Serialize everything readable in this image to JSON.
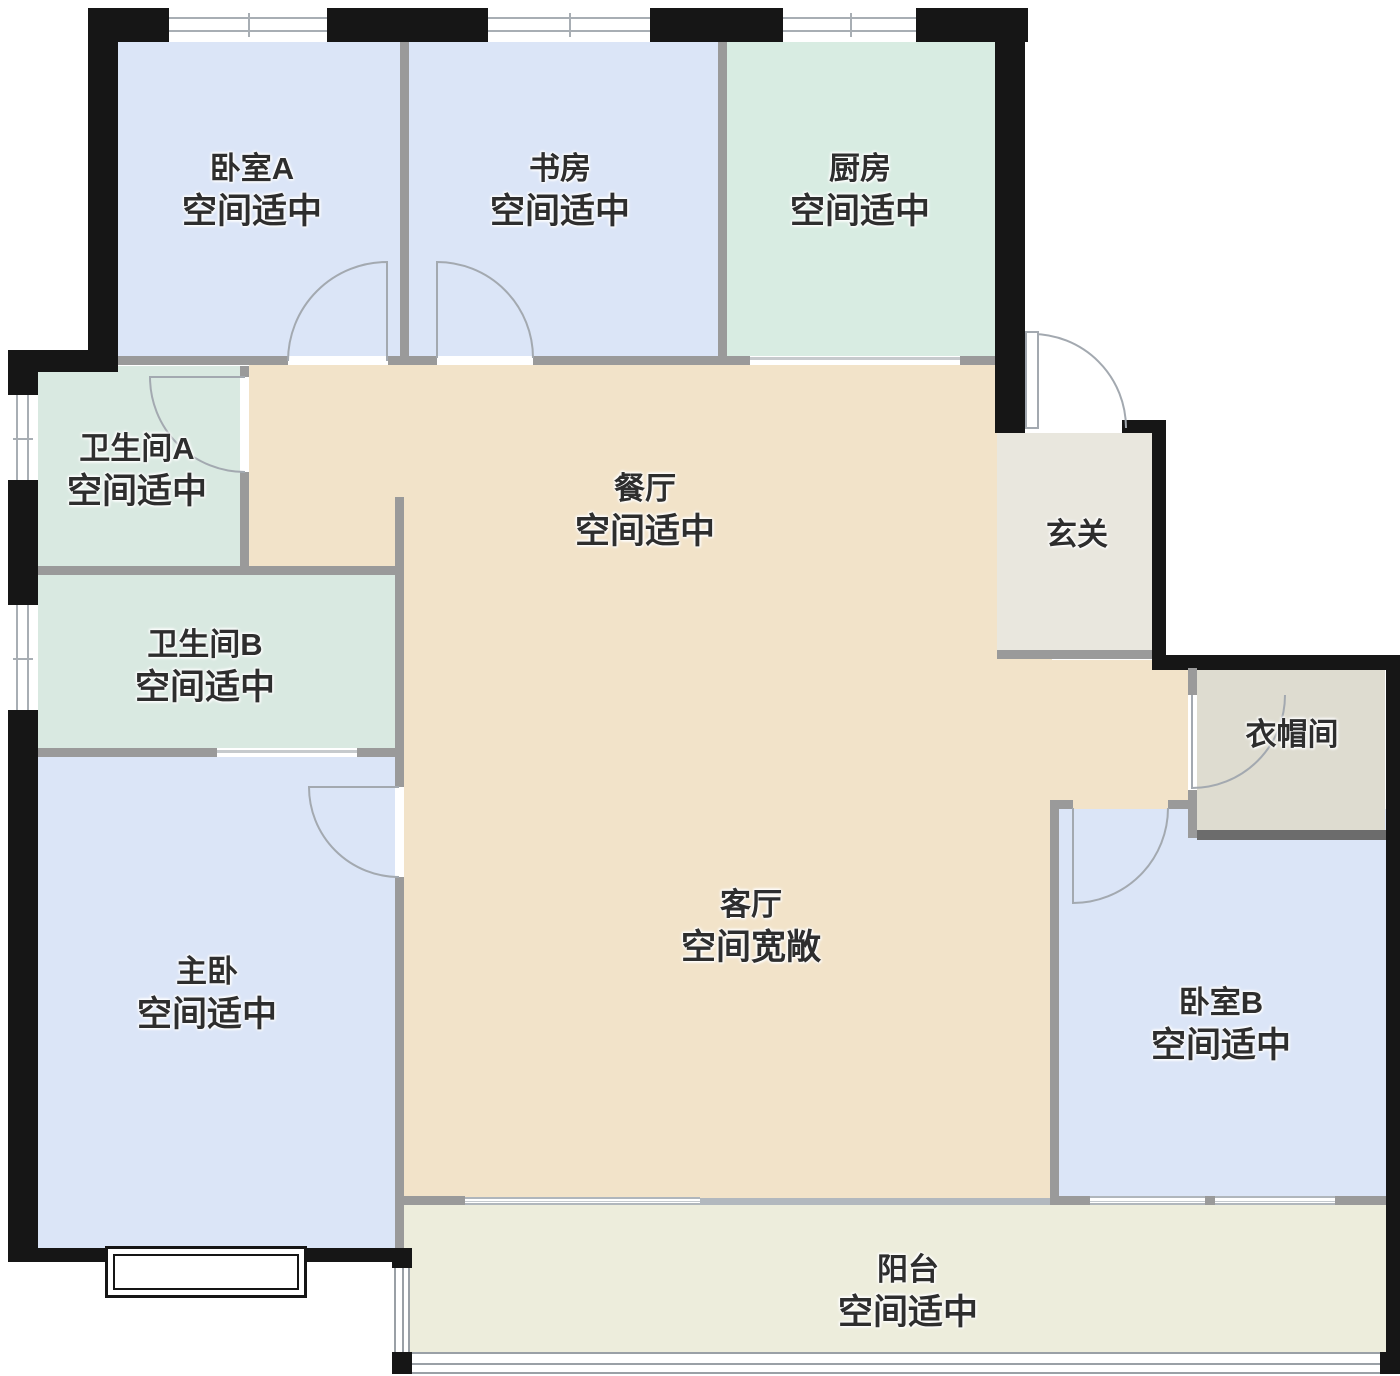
{
  "title": "户型图",
  "rooms": [
    {
      "key": "bedroom-a",
      "name": "卧室A",
      "status": "空间适中"
    },
    {
      "key": "study",
      "name": "书房",
      "status": "空间适中"
    },
    {
      "key": "kitchen",
      "name": "厨房",
      "status": "空间适中"
    },
    {
      "key": "bathroom-a",
      "name": "卫生间A",
      "status": "空间适中"
    },
    {
      "key": "bathroom-b",
      "name": "卫生间B",
      "status": "空间适中"
    },
    {
      "key": "dining",
      "name": "餐厅",
      "status": "空间适中"
    },
    {
      "key": "foyer",
      "name": "玄关",
      "status": ""
    },
    {
      "key": "cloakroom",
      "name": "衣帽间",
      "status": ""
    },
    {
      "key": "master-bedroom",
      "name": "主卧",
      "status": "空间适中"
    },
    {
      "key": "living",
      "name": "客厅",
      "status": "空间宽敞"
    },
    {
      "key": "bedroom-b",
      "name": "卧室B",
      "status": "空间适中"
    },
    {
      "key": "balcony",
      "name": "阳台",
      "status": "空间适中"
    }
  ],
  "colors": {
    "wall": "#161616",
    "innerWall": "#9a9a9a",
    "bedroom": "#dbe5f7",
    "kitchen": "#d8ece2",
    "bath": "#d9e9e1",
    "public": "#f2e3c9",
    "foyer": "#e9e7de",
    "cloakroom": "#dedcd0",
    "balcony": "#ededdc",
    "doorStroke": "#a3a9b0",
    "label": "#2e2e2e"
  }
}
